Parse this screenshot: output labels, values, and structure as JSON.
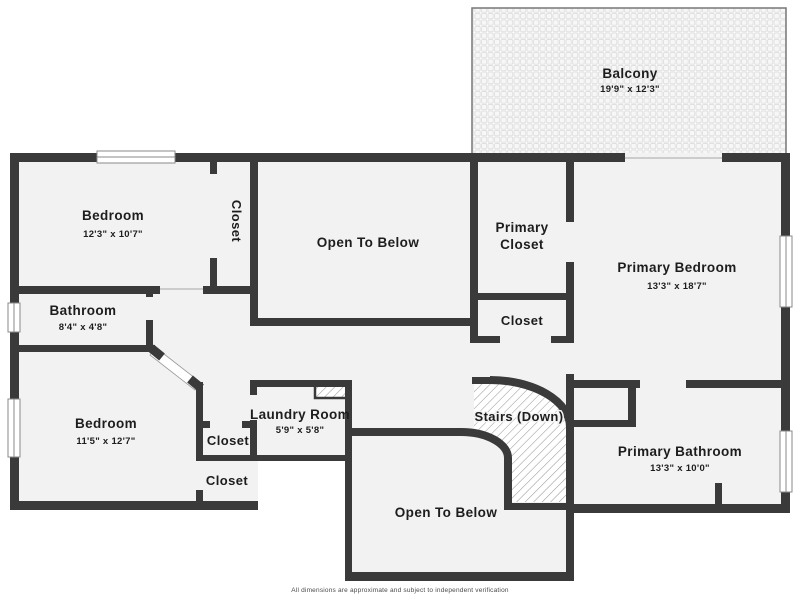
{
  "plan": {
    "rooms": {
      "balcony": {
        "name": "Balcony",
        "dims": "19'9\" x 12'3\""
      },
      "bedroom_tl": {
        "name": "Bedroom",
        "dims": "12'3\" x 10'7\""
      },
      "closet_tl": {
        "name": "Closet"
      },
      "otb_center": {
        "name": "Open To Below"
      },
      "primary_closet": {
        "name": "Primary Closet",
        "lines": [
          "Primary",
          "Closet"
        ]
      },
      "primary_bedroom": {
        "name": "Primary Bedroom",
        "dims": "13'3\" x 18'7\""
      },
      "bathroom": {
        "name": "Bathroom",
        "dims": "8'4\" x 4'8\""
      },
      "closet_hall": {
        "name": "Closet"
      },
      "bedroom_bl": {
        "name": "Bedroom",
        "dims": "11'5\" x 12'7\""
      },
      "laundry": {
        "name": "Laundry Room",
        "dims": "5'9\" x 5'8\""
      },
      "stairs": {
        "name": "Stairs (Down)"
      },
      "primary_bathroom": {
        "name": "Primary Bathroom",
        "dims": "13'3\" x 10'0\""
      },
      "closet_a": {
        "name": "Closet"
      },
      "closet_b": {
        "name": "Closet"
      },
      "otb_bottom": {
        "name": "Open To Below"
      }
    },
    "footer": {
      "disclaimer": "All dimensions are approximate and subject to independent verification"
    },
    "palette": {
      "wall": "#3a3a3a",
      "floor": "#f2f2f2",
      "exterior": "#ffffff",
      "hatch_line": "#9a9a9a",
      "paver_line": "#e0e0e0",
      "window_outline": "#8a8a8a",
      "text": "#1d1d1d"
    }
  }
}
